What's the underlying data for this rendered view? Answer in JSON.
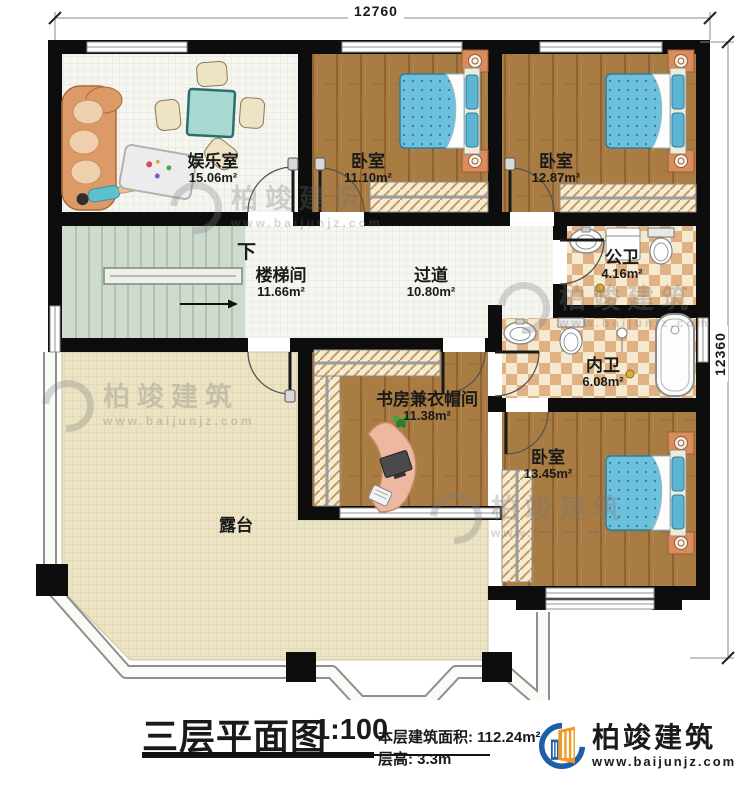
{
  "dimensions": {
    "width_top": "12760",
    "height_right": "12360"
  },
  "stairs": {
    "direction_label": "下"
  },
  "rooms": [
    {
      "id": "entertainment",
      "name": "娱乐室",
      "area": "15.06m²"
    },
    {
      "id": "bedroom-top-middle",
      "name": "卧室",
      "area": "11.10m²"
    },
    {
      "id": "bedroom-top-right",
      "name": "卧室",
      "area": "12.87m²"
    },
    {
      "id": "public-bath",
      "name": "公卫",
      "area": "4.16m²"
    },
    {
      "id": "stairwell",
      "name": "楼梯间",
      "area": "11.66m²"
    },
    {
      "id": "hallway",
      "name": "过道",
      "area": "10.80m²"
    },
    {
      "id": "private-bath",
      "name": "内卫",
      "area": "6.08m²"
    },
    {
      "id": "study-cloakroom",
      "name": "书房兼衣帽间",
      "area": "11.38m²"
    },
    {
      "id": "bedroom-bottom-right",
      "name": "卧室",
      "area": "13.45m²"
    },
    {
      "id": "terrace",
      "name": "露台",
      "area": ""
    }
  ],
  "title_block": {
    "plan_name": "三层平面图",
    "scale": "1:100",
    "floor_area_label": "本层建筑面积:",
    "floor_area_value": "112.24m²",
    "floor_height_label": "层高:",
    "floor_height_value": "3.3m"
  },
  "brand": {
    "name": "柏竣建筑",
    "website": "www.baijunjz.com"
  },
  "watermark": {
    "name": "柏竣建筑",
    "website": "www.baijunjz.com"
  },
  "colors": {
    "wall": "#0d0d0d",
    "wood_floor": "#a97c44",
    "tile_accent": "#dfb183",
    "terrace_floor": "#ebe3c4",
    "stair_floor": "#cfdbce",
    "bed": "#6ec1dd",
    "brand_blue": "#1f5fa8",
    "brand_orange": "#f29a1f"
  }
}
